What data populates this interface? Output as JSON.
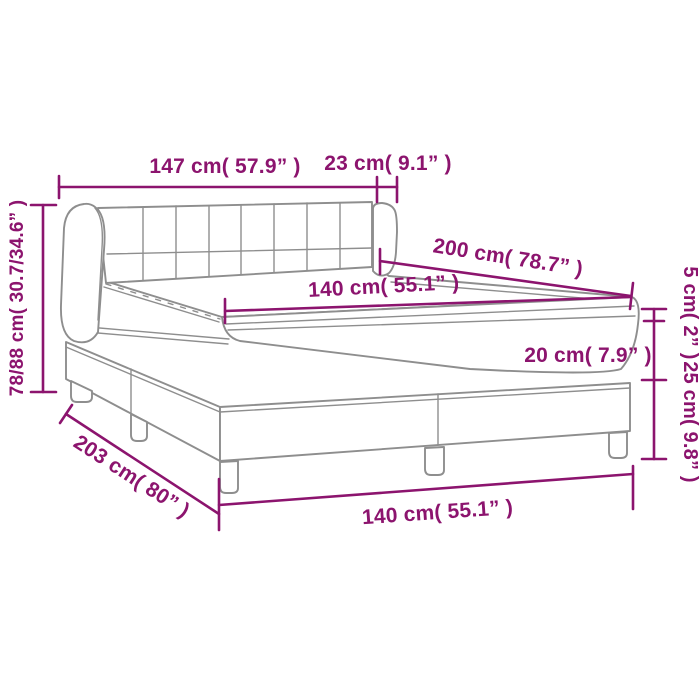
{
  "diagram": {
    "subject": "box-spring-bed-dimension-diagram"
  },
  "labels": {
    "headboard_width": "147 cm( 57.9” )",
    "headboard_wing_depth": "23 cm( 9.1” )",
    "headboard_height": "78/88 cm( 30.7/34.6” )",
    "bed_length_top": "200 cm( 78.7” )",
    "mattress_width": "140 cm( 55.1” )",
    "topper_thickness": "5 cm( 2” )",
    "mattress_thickness": "20 cm( 7.9” )",
    "base_height": "25 cm( 9.8” )",
    "base_length": "203 cm( 80” )",
    "base_width": "140 cm( 55.1” )"
  },
  "colors": {
    "dimension": "#8C146E",
    "outline": "#8E8E8E",
    "background": "#FFFFFF"
  }
}
